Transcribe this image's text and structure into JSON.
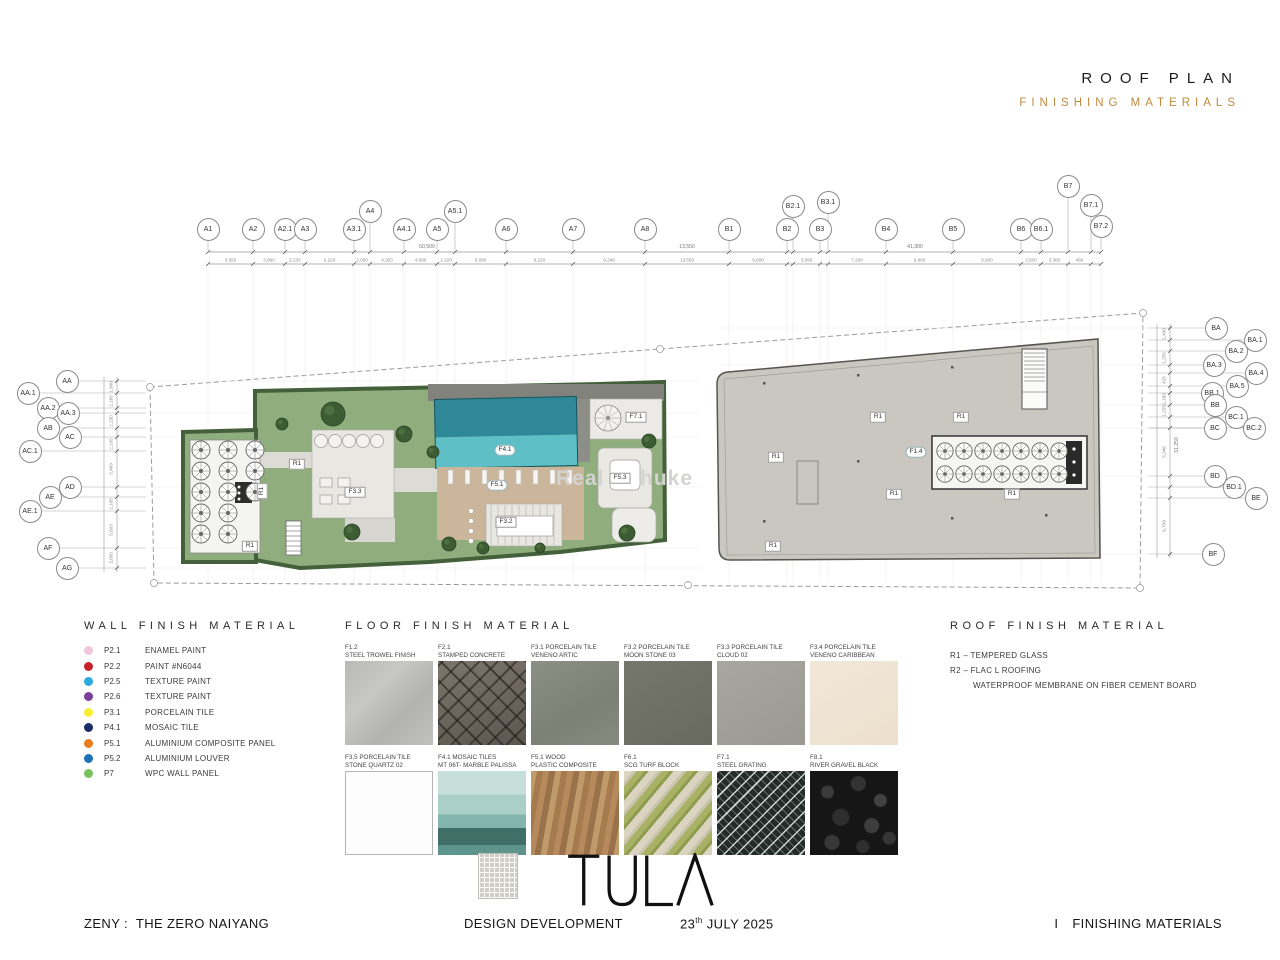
{
  "header": {
    "title": "ROOF PLAN",
    "subtitle": "FINISHING MATERIALS",
    "subtitle_color": "#c08a3e"
  },
  "plan": {
    "grid_top": [
      "A1",
      "A2",
      "A2.1",
      "A3",
      "A3.1",
      "A4",
      "A4.1",
      "A5",
      "A5.1",
      "A6",
      "A7",
      "A8",
      "B1",
      "B2",
      "B2.1",
      "B3",
      "B3.1",
      "B4",
      "B5",
      "B6",
      "B6.1",
      "B7",
      "B7.1",
      "B7.2"
    ],
    "grid_left": [
      "AA",
      "AA.1",
      "AA.2",
      "AA.3",
      "AB",
      "AC",
      "AC.1",
      "AD",
      "AE",
      "AE.1",
      "AF",
      "AG"
    ],
    "grid_right": [
      "BA",
      "BA.1",
      "BA.2",
      "BA.3",
      "BA.4",
      "BA.5",
      "BB.1",
      "BB",
      "BC.1",
      "BC",
      "BC.2",
      "BD",
      "BD.1",
      "BE",
      "BF"
    ],
    "dims_top": [
      "3,550",
      "3,860",
      "2,230",
      "6,220",
      "2,050",
      "4,303",
      "4,090",
      "1,220",
      "6,090",
      "8,220",
      "9,346",
      "13,550",
      "6,800",
      "450",
      "3,090",
      "1,200",
      "7,200",
      "6,800",
      "9,600",
      "2,500",
      "3,380",
      "460",
      "130"
    ],
    "dims_top_totals": [
      "50,500",
      "13,550",
      "41,300"
    ],
    "dims_left": [
      "1,900",
      "2,165",
      "740",
      "2,230",
      "1,175",
      "2,105",
      "5,469",
      "1,483",
      "2,105",
      "5,603",
      "3,050"
    ],
    "dims_right": [
      "1,430",
      "870",
      "1,255",
      "710",
      "425",
      "225",
      "1,180",
      "1,255",
      "945",
      "5,346",
      "1,255",
      "1,020",
      "6,709"
    ],
    "dims_right_total": "31,250",
    "tags": {
      "r1": "R1",
      "f14": "F1.4",
      "f41": "F4.1",
      "f51": "F5.1",
      "f32": "F3.2",
      "f33": "F3.3",
      "f53": "F5.3",
      "f71": "F7.1"
    },
    "watermark": {
      "part1": "Real",
      "part2": "huke"
    }
  },
  "wall_legend": {
    "header": "WALL FINISH MATERIAL",
    "items": [
      {
        "code": "P2.1",
        "label": "ENAMEL PAINT",
        "color": "#f2c7dc"
      },
      {
        "code": "P2.2",
        "label": "PAINT #N6044",
        "color": "#c8202a"
      },
      {
        "code": "P2.5",
        "label": "TEXTURE PAINT",
        "color": "#29abe2"
      },
      {
        "code": "P2.6",
        "label": "TEXTURE PAINT",
        "color": "#7b3f9b"
      },
      {
        "code": "P3.1",
        "label": "PORCELAIN TILE",
        "color": "#f9ed32"
      },
      {
        "code": "P4.1",
        "label": "MOSAIC TILE",
        "color": "#1b2d69"
      },
      {
        "code": "P5.1",
        "label": "ALUMINIUM COMPOSITE PANEL",
        "color": "#e87c1e"
      },
      {
        "code": "P5.2",
        "label": "ALUMINIUM  LOUVER",
        "color": "#1d70b8"
      },
      {
        "code": "P7",
        "label": "WPC WALL PANEL",
        "color": "#7ac25c"
      }
    ]
  },
  "floor_legend": {
    "header": "FLOOR FINISH MATERIAL",
    "items": [
      {
        "code_line": "F1.2",
        "name_line": "STEEL TROWEL FINISH",
        "swatch": "sw-f12"
      },
      {
        "code_line": "F2.1",
        "name_line": "STAMPED CONCRETE",
        "swatch": "sw-f21"
      },
      {
        "code_line": "F3.1 PORCELAIN TILE",
        "name_line": "VENENO ARTIC",
        "swatch": "sw-f31"
      },
      {
        "code_line": "F3.2 PORCELAIN TILE",
        "name_line": "MOON STONE 03",
        "swatch": "sw-f32"
      },
      {
        "code_line": "F3.3 PORCELAIN TILE",
        "name_line": "CLOUD 02",
        "swatch": "sw-f33"
      },
      {
        "code_line": "F3.4 PORCELAIN TILE",
        "name_line": "VENENO CARIBBEAN",
        "swatch": "sw-f34"
      },
      {
        "code_line": "F3.5 PORCELAIN TILE",
        "name_line": "STONE QUARTZ 02",
        "swatch": "sw-f35"
      },
      {
        "code_line": "F4.1 MOSAIC TILES",
        "name_line": "MT 06T- MARBLE PALISSA",
        "swatch": "sw-f41m",
        "has_sub_swatch": true
      },
      {
        "code_line": "F5.1 WOOD",
        "name_line": "PLASTIC COMPOSITE",
        "swatch": "sw-f51"
      },
      {
        "code_line": "F6.1",
        "name_line": "SCG TURF BLOCK",
        "swatch": "sw-f61"
      },
      {
        "code_line": "F7.1",
        "name_line": "STEEL GRATING",
        "swatch": "sw-f71"
      },
      {
        "code_line": "F8.1",
        "name_line": "RIVER GRAVEL BLACK",
        "swatch": "sw-f81"
      }
    ]
  },
  "roof_legend": {
    "header": "ROOF FINISH MATERIAL",
    "items": [
      "R1 – TEMPERED GLASS",
      "R2 – FLAC L ROOFING"
    ],
    "note": "WATERPROOF MEMBRANE ON FIBER CEMENT BOARD"
  },
  "footer": {
    "logo": "TULA",
    "project": "ZENY :  THE ZERO NAIYANG",
    "phase": "DESIGN DEVELOPMENT",
    "date_day": "23",
    "date_sup": "th",
    "date_rest": " JULY 2025",
    "sheet_index": "I",
    "sheet_label": "FINISHING MATERIALS"
  }
}
